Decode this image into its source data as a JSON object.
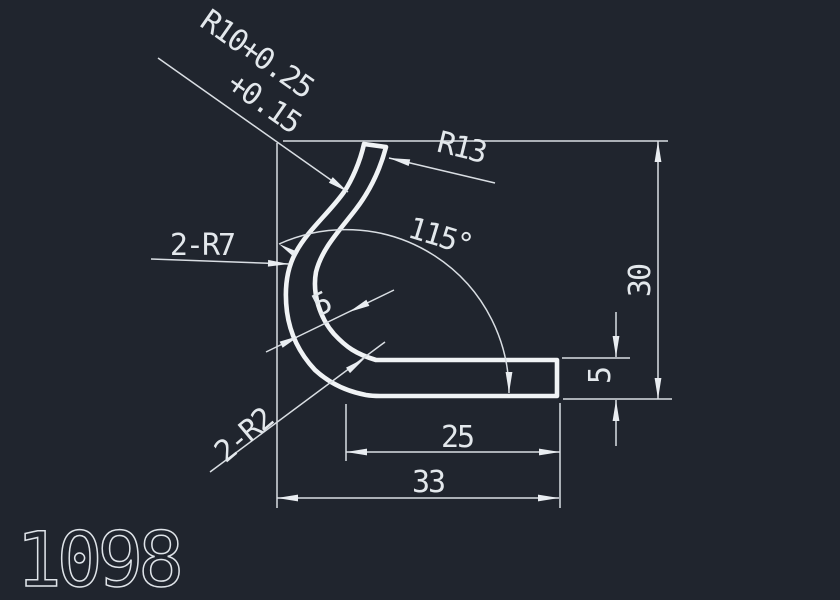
{
  "canvas": {
    "background": "#20252e",
    "object_line_color": "#f0f3f5",
    "dimension_line_color": "#d9dee3"
  },
  "labels": {
    "r10_tolerance_line1": "R10+0.25",
    "r10_tolerance_line2": "+0.15",
    "r13": "R13",
    "angle": "115°",
    "r7_double": "2-R7",
    "wall_thickness": "5",
    "r2_double": "2-R2",
    "length_25": "25",
    "length_33": "33",
    "height_30": "30",
    "flange_thickness": "5",
    "drawing_number": "1098"
  }
}
